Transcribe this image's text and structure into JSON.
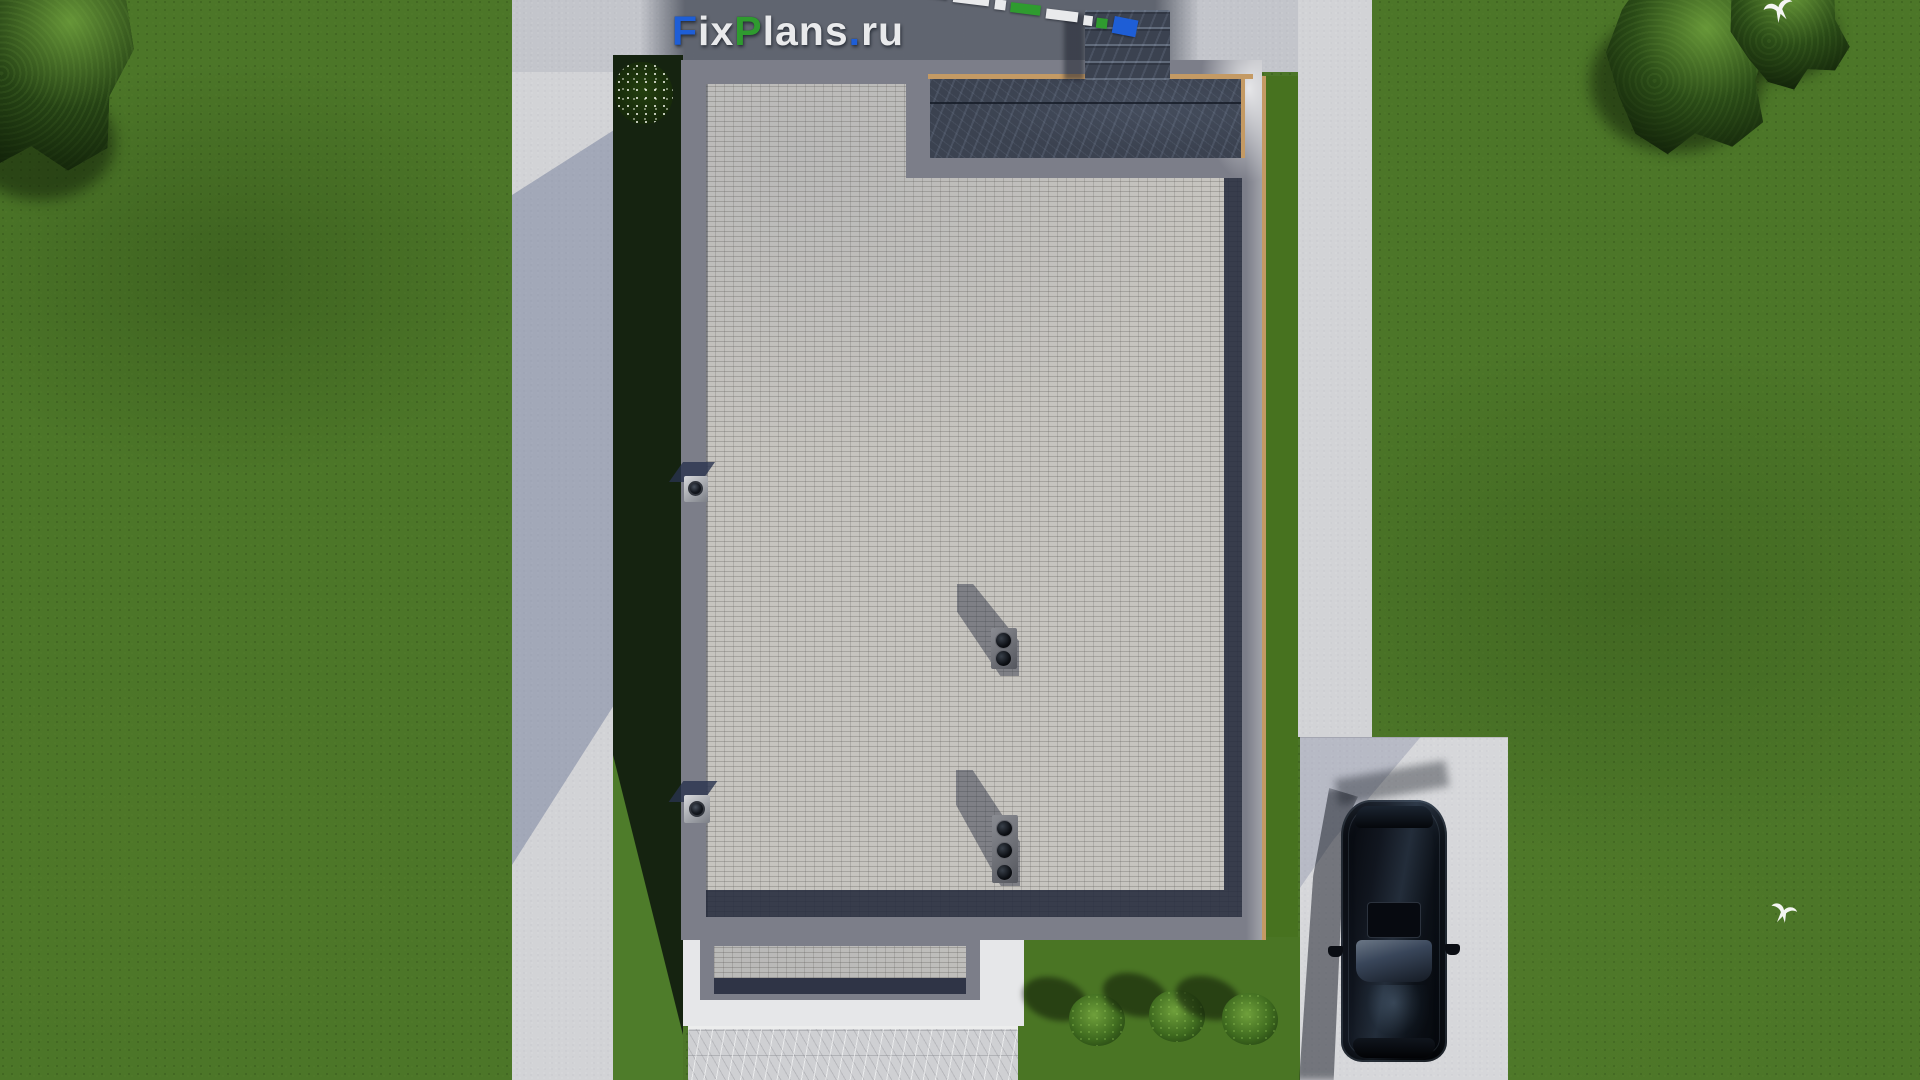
{
  "watermark": {
    "text": "FixPlans.ru",
    "parts": [
      {
        "t": "F",
        "c": "#1e5ed6"
      },
      {
        "t": "ix",
        "c": "#e9eaec"
      },
      {
        "t": "P",
        "c": "#2f9b2f"
      },
      {
        "t": "lans",
        "c": "#e9eaec"
      },
      {
        "t": ".",
        "c": "#1e5ed6"
      },
      {
        "t": "ru",
        "c": "#e9eaec"
      }
    ]
  },
  "scene": {
    "view": "top-down 3D architectural render of a house plot",
    "building": {
      "roof": "flat light-gray tiled roof with gray parapet frame",
      "terrace": "dark slate terrace in top-right corner with tan wood trim",
      "stairs": "dark slate steps above terrace",
      "roof_vents": [
        {
          "flues": 2
        },
        {
          "flues": 3
        }
      ],
      "wall_lights": 2,
      "entrance_canopy": "small tiled canopy over bottom entrance",
      "flower_bush": "white-flowering shrub at top-left of building"
    },
    "grounds": {
      "lawn": "green grass surrounding plot",
      "left_path": "concrete path, west side",
      "top_apron": "concrete apron with dark pavement strip, north side",
      "right_path": "concrete path, east side",
      "driveway": "concrete driveway, south-east",
      "entrance_walkway": "marble-textured walkway, south",
      "shrubs_count": 3,
      "trees_top_left": 1,
      "trees_top_right": 2,
      "birds_count": 2
    },
    "vehicle": {
      "type": "black SUV",
      "state": "parked on driveway, nose down"
    }
  },
  "palette": {
    "grass": "#4c7628",
    "concrete": "#d2d3d6",
    "dark_pavement": "#5a5f6a",
    "parapet_gray": "#7c7e89",
    "roof_tile": "#c6c4bf",
    "shadow_navy": "#2a3244",
    "slate": "#3b4250",
    "tan_trim": "#c49a64",
    "logo_blue": "#1e5ed6",
    "logo_green": "#2f9b2f",
    "logo_white": "#e9eaec"
  }
}
